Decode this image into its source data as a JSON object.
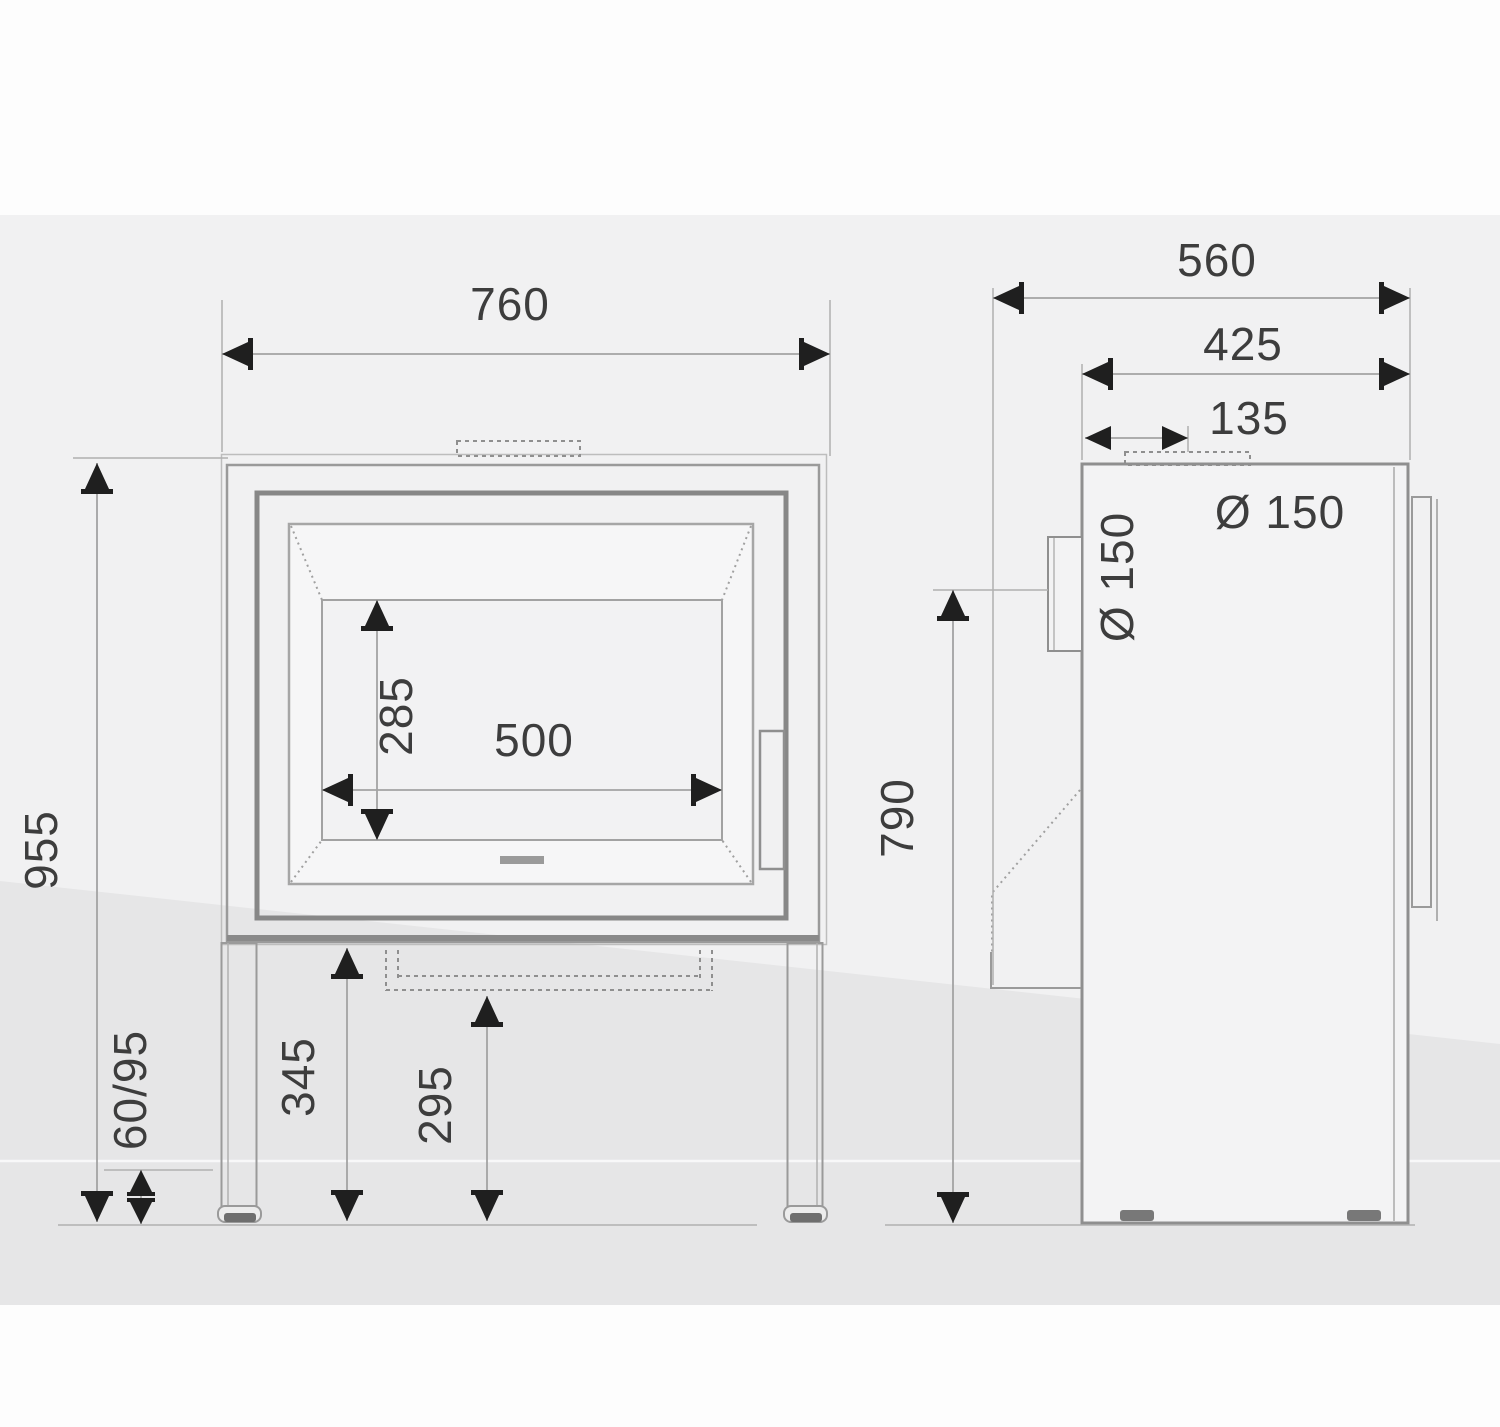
{
  "drawing": {
    "type": "technical-dimension-drawing",
    "views": [
      "front-view",
      "side-view"
    ],
    "front": {
      "overall_width": "760",
      "overall_height": "955",
      "foot_height": "60/95",
      "glass_opening_height": "285",
      "glass_opening_width": "500",
      "underside_height": "345",
      "drawer_height": "295"
    },
    "side": {
      "overall_depth": "560",
      "body_depth": "425",
      "flue_offset": "135",
      "top_flue_diameter": "Ø 150",
      "rear_flue_diameter": "Ø 150",
      "rear_flue_centre_height": "790"
    },
    "colors": {
      "body_outline": "#8f8f8f",
      "dimension_line": "#a3a3a3",
      "dimension_text": "#3d3d3d",
      "arrow": "#1f1f1f",
      "background_band": "#e6e6e7",
      "background": "#f1f1f2"
    }
  }
}
